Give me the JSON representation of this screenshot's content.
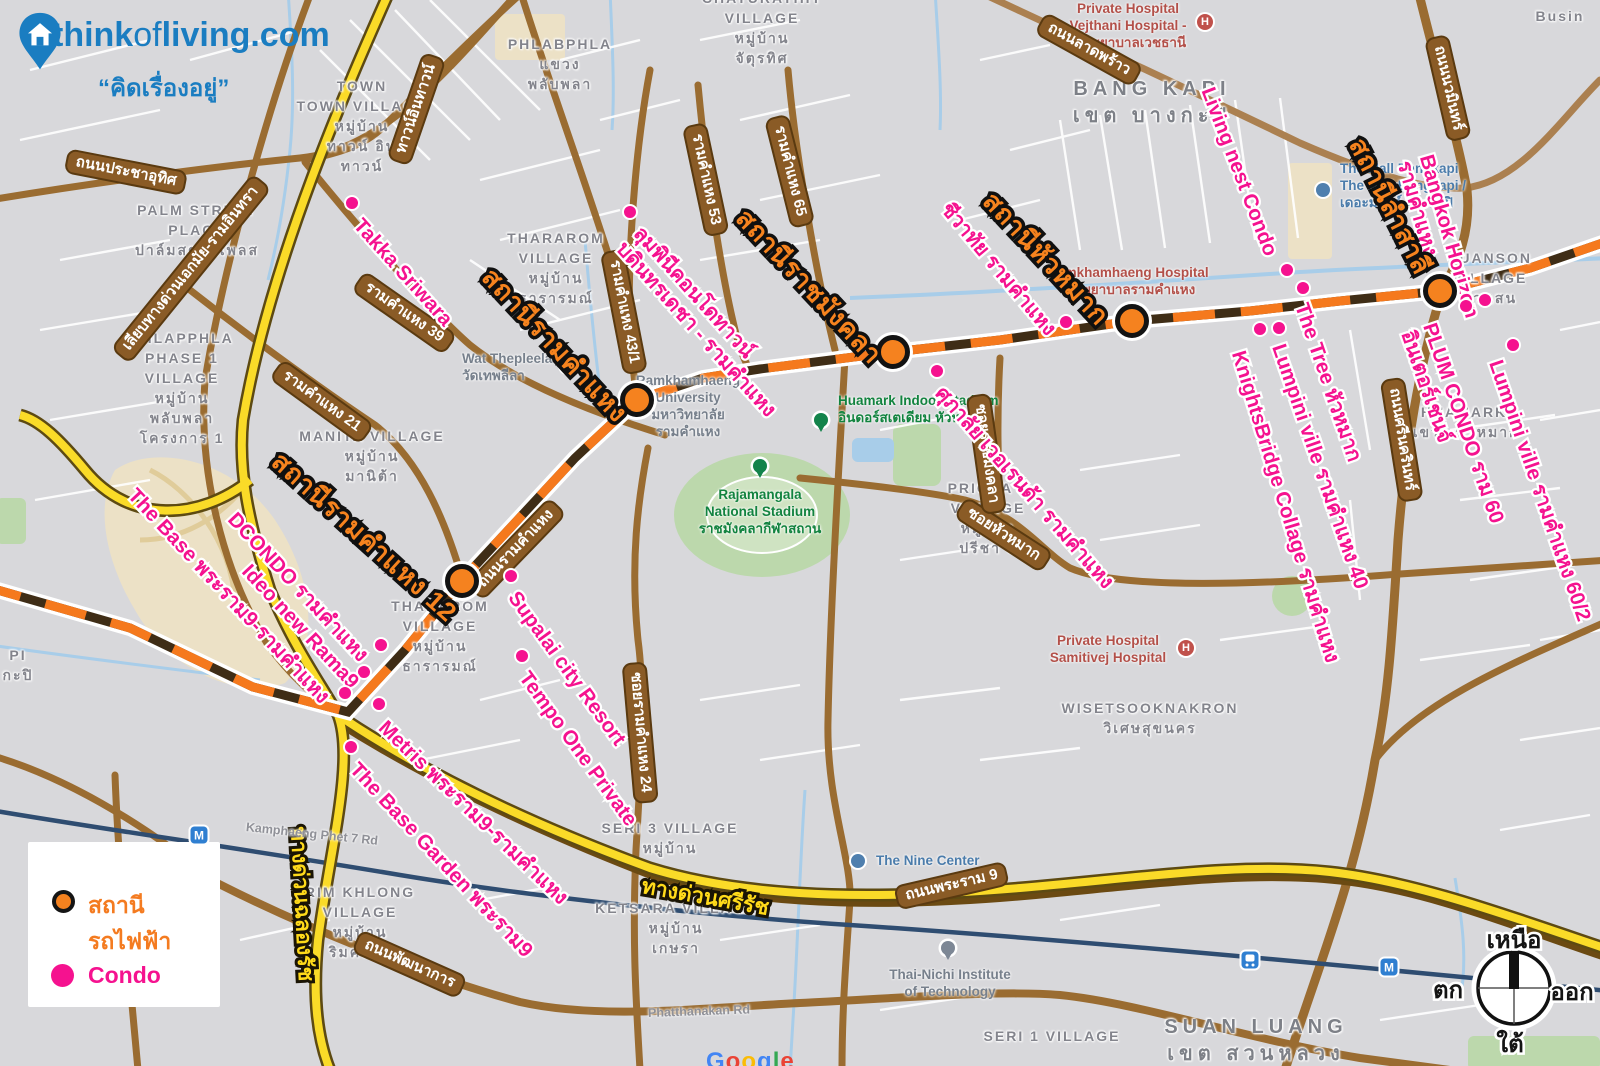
{
  "logo": {
    "site_think": "think",
    "site_of": "of",
    "site_living": "living.com",
    "tagline": "“คิดเรื่องอยู่”"
  },
  "legend": {
    "items": [
      {
        "label": "สถานีรถไฟฟ้า",
        "type": "station"
      },
      {
        "label": "Condo",
        "type": "condo"
      }
    ]
  },
  "compass": {
    "north": "เหนือ",
    "south": "ใต้",
    "west": "ตก",
    "east": "ออก"
  },
  "colors": {
    "transit_orange": "#f5791d",
    "condo_pink": "#f5128f",
    "station_label_orange": "#f6831e",
    "road_brown": "#9a6c31",
    "expressway_yellow": "#fadb28",
    "logo_blue": "#1a7dc1"
  },
  "icon_glyphs": {
    "hospital": "H",
    "metro": "M"
  },
  "watermark": {
    "text": "Google",
    "letter_colors": [
      "#4285F4",
      "#EA4335",
      "#FBBC05",
      "#4285F4",
      "#34A853",
      "#EA4335"
    ]
  },
  "stations": [
    {
      "name": "สถานีรามคำแหง 12",
      "marker": {
        "x": 462,
        "y": 581
      },
      "label": {
        "x": 286,
        "y": 446,
        "rot": 42
      }
    },
    {
      "name": "สถานีรามคำแหง",
      "marker": {
        "x": 637,
        "y": 400
      },
      "label": {
        "x": 498,
        "y": 262,
        "rot": 47
      }
    },
    {
      "name": "สถานีราชมังคลา",
      "marker": {
        "x": 893,
        "y": 352
      },
      "label": {
        "x": 752,
        "y": 203,
        "rot": 47
      }
    },
    {
      "name": "สถานีหัวหมาก",
      "marker": {
        "x": 1132,
        "y": 321
      },
      "label": {
        "x": 999,
        "y": 186,
        "rot": 47
      }
    },
    {
      "name": "สถานีลำสาลี",
      "marker": {
        "x": 1440,
        "y": 291
      },
      "label": {
        "x": 1370,
        "y": 133,
        "rot": 63
      }
    }
  ],
  "condos": [
    {
      "lines": [
        "Takka Sriwara"
      ],
      "dot": {
        "x": 352,
        "y": 203
      },
      "label": {
        "x": 366,
        "y": 214,
        "rot": 48
      }
    },
    {
      "lines": [
        "ลุมพินีคอนโดทาวน์",
        "บดินทรเดชา - รามคำแหง"
      ],
      "dot": {
        "x": 630,
        "y": 212
      },
      "label": {
        "x": 646,
        "y": 222,
        "rot": 48
      }
    },
    {
      "lines": [
        "ชีวาทัย รามคำแหง"
      ],
      "dot": {
        "x": 1066,
        "y": 322
      },
      "label": {
        "x": 954,
        "y": 198,
        "rot": 50
      }
    },
    {
      "lines": [
        "ศุภาลัย เวอเรนด้า รามคำแหง"
      ],
      "dot": {
        "x": 937,
        "y": 371
      },
      "label": {
        "x": 948,
        "y": 382,
        "rot": 49
      }
    },
    {
      "lines": [
        "DCONDO รามคำแหง"
      ],
      "dot": {
        "x": 381,
        "y": 645
      },
      "label": {
        "x": 240,
        "y": 508,
        "rot": 47
      }
    },
    {
      "lines": [
        "Ideo new Rama9"
      ],
      "dot": {
        "x": 364,
        "y": 672
      },
      "label": {
        "x": 254,
        "y": 560,
        "rot": 47
      }
    },
    {
      "lines": [
        "The Base พระราม9-รามคำแหง"
      ],
      "dot": {
        "x": 345,
        "y": 693
      },
      "label": {
        "x": 140,
        "y": 484,
        "rot": 47
      }
    },
    {
      "lines": [
        "Metris พระราม9-รามคำแหง"
      ],
      "dot": {
        "x": 379,
        "y": 704
      },
      "label": {
        "x": 390,
        "y": 716,
        "rot": 44
      }
    },
    {
      "lines": [
        "The Base Garden พระราม9"
      ],
      "dot": {
        "x": 351,
        "y": 747
      },
      "label": {
        "x": 362,
        "y": 758,
        "rot": 47
      }
    },
    {
      "lines": [
        "Supalai city Resort"
      ],
      "dot": {
        "x": 511,
        "y": 576
      },
      "label": {
        "x": 522,
        "y": 587,
        "rot": 54
      }
    },
    {
      "lines": [
        "Tempo One Private"
      ],
      "dot": {
        "x": 522,
        "y": 656
      },
      "label": {
        "x": 533,
        "y": 667,
        "rot": 54
      }
    },
    {
      "lines": [
        "Living nest Condo"
      ],
      "dot": {
        "x": 1287,
        "y": 270
      },
      "label": {
        "x": 1218,
        "y": 84,
        "rot": 69
      }
    },
    {
      "lines": [
        "The Tree หัวหมาก"
      ],
      "dot": {
        "x": 1303,
        "y": 288
      },
      "label": {
        "x": 1312,
        "y": 300,
        "rot": 71
      }
    },
    {
      "lines": [
        "Lumpini ville รามคำแหง 40"
      ],
      "dot": {
        "x": 1279,
        "y": 328
      },
      "label": {
        "x": 1289,
        "y": 341,
        "rot": 71
      }
    },
    {
      "lines": [
        "KnightsBridge Collage รามคำแหง"
      ],
      "dot": {
        "x": 1260,
        "y": 329
      },
      "label": {
        "x": 1249,
        "y": 348,
        "rot": 73
      }
    },
    {
      "lines": [
        "Bangkok Horizon",
        "รามคำแหง"
      ],
      "dot": {
        "x": 1485,
        "y": 300
      },
      "label": {
        "x": 1437,
        "y": 152,
        "rot": 74
      }
    },
    {
      "lines": [
        "PLUM CONDO ราม 60",
        "อินเตอร์เชนจ์"
      ],
      "dot": {
        "x": 1466,
        "y": 306
      },
      "label": {
        "x": 1440,
        "y": 320,
        "rot": 71
      }
    },
    {
      "lines": [
        "Lumpini ville รามคำแหง 60/2"
      ],
      "dot": {
        "x": 1513,
        "y": 345
      },
      "label": {
        "x": 1506,
        "y": 357,
        "rot": 71
      }
    }
  ],
  "road_labels": [
    {
      "text": "ถนนประชาอุทิศ",
      "x": 66,
      "y": 148,
      "rot": 11,
      "kind": "brown"
    },
    {
      "text": "เลียบทางด่วนเอกมัย-รามอินทรา",
      "x": 120,
      "y": 344,
      "rot": -51,
      "kind": "brown"
    },
    {
      "text": "ทาวน์อินทาวน์",
      "x": 398,
      "y": 150,
      "rot": -71,
      "kind": "brown"
    },
    {
      "text": "รามคำแหง 39",
      "x": 358,
      "y": 268,
      "rot": 35,
      "kind": "brown"
    },
    {
      "text": "รามคำแหง 21",
      "x": 276,
      "y": 356,
      "rot": 36,
      "kind": "brown"
    },
    {
      "text": "รามคำแหง 43/1",
      "x": 612,
      "y": 238,
      "rot": 79,
      "kind": "brown"
    },
    {
      "text": "รามคำแหง 53",
      "x": 694,
      "y": 112,
      "rot": 78,
      "kind": "brown"
    },
    {
      "text": "รามคำแหง 65",
      "x": 776,
      "y": 104,
      "rot": 76,
      "kind": "brown"
    },
    {
      "text": "ถนนลาดพร้าว",
      "x": 1040,
      "y": 10,
      "rot": 29,
      "kind": "brown"
    },
    {
      "text": "ถนนนวมินทร์",
      "x": 1436,
      "y": 24,
      "rot": 77,
      "kind": "brown"
    },
    {
      "text": "ถนนศรีนครินทร์",
      "x": 1392,
      "y": 366,
      "rot": 81,
      "kind": "brown"
    },
    {
      "text": "ถนนรามคำแหง",
      "x": 474,
      "y": 580,
      "rot": -46,
      "kind": "brown"
    },
    {
      "text": "ซอยรามคำแหง 24",
      "x": 634,
      "y": 650,
      "rot": 85,
      "kind": "brown"
    },
    {
      "text": "ซอยหัวหมาก",
      "x": 960,
      "y": 494,
      "rot": 33,
      "kind": "brown"
    },
    {
      "text": "ซอยราชมังคลา",
      "x": 978,
      "y": 382,
      "rot": 82,
      "kind": "brown"
    },
    {
      "text": "ถนนพระราม 9",
      "x": 896,
      "y": 886,
      "rot": -13,
      "kind": "brown"
    },
    {
      "text": "ถนนพัฒนาการ",
      "x": 356,
      "y": 928,
      "rot": 24,
      "kind": "brown"
    },
    {
      "text": "ทางด่วนศรีรัช",
      "x": 644,
      "y": 874,
      "rot": 10,
      "kind": "yellow"
    },
    {
      "text": "ทางด่วนฉลองรัช",
      "x": 310,
      "y": 826,
      "rot": 87,
      "kind": "yellow"
    },
    {
      "text": "Kamphaeng Phet 7 Rd",
      "x": 246,
      "y": 820,
      "rot": 6,
      "kind": "greyroad"
    },
    {
      "text": "Phatthanakan Rd",
      "x": 648,
      "y": 1006,
      "rot": -2,
      "kind": "greyroad"
    }
  ],
  "area_labels": [
    {
      "lines": [
        "PALM STREET",
        "PLACE",
        "ปาล์มสตรีทเพลส"
      ],
      "x": 197,
      "y": 200
    },
    {
      "lines": [
        "TOWN",
        "TOWN VILLAGE",
        "หมู่บ้าน",
        "ทาวน์ อิน",
        "ทาวน์"
      ],
      "x": 362,
      "y": 76
    },
    {
      "lines": [
        "PHLABPHLA",
        "แขวง",
        "พลับพลา"
      ],
      "x": 560,
      "y": 34
    },
    {
      "lines": [
        "PHLAPPHLA",
        "PHASE 1",
        "VILLAGE",
        "หมู่บ้าน",
        "พลับพลา",
        "โครงการ 1"
      ],
      "x": 182,
      "y": 328
    },
    {
      "lines": [
        "THARAROM",
        "VILLAGE",
        "หมู่บ้าน",
        "ธารารมณ์"
      ],
      "x": 556,
      "y": 228
    },
    {
      "lines": [
        "THARAROM",
        "VILLAGE",
        "หมู่บ้าน",
        "ธารารมณ์"
      ],
      "x": 440,
      "y": 596
    },
    {
      "lines": [
        "MANITA VILLAGE",
        "หมู่บ้าน",
        "มานิต้า"
      ],
      "x": 372,
      "y": 426
    },
    {
      "lines": [
        "PRICHA 8",
        "VILLAGE",
        "หมู่บ้าน",
        "ปรีชา 8"
      ],
      "x": 988,
      "y": 478
    },
    {
      "lines": [
        "SERI 3 VILLAGE",
        "หมู่บ้าน"
      ],
      "x": 670,
      "y": 818
    },
    {
      "lines": [
        "KETSARA VILLAGE",
        "หมู่บ้าน",
        "เกษรา"
      ],
      "x": 676,
      "y": 898
    },
    {
      "lines": [
        "SERI 1 VILLAGE"
      ],
      "x": 1052,
      "y": 1026
    },
    {
      "lines": [
        "RIM KHLONG",
        "VILLAGE",
        "หมู่บ้าน",
        "ริมคลอง"
      ],
      "x": 360,
      "y": 882
    },
    {
      "lines": [
        "WISETSOOKNAKRON",
        "วิเศษสุขนคร"
      ],
      "x": 1150,
      "y": 698
    },
    {
      "lines": [
        "BANG KAPI",
        "เขต บางกะปิ"
      ],
      "x": 1152,
      "y": 76,
      "cls": "district"
    },
    {
      "lines": [
        "SUAN LUANG",
        "เขต สวนหลวง"
      ],
      "x": 1256,
      "y": 1014,
      "cls": "district"
    },
    {
      "lines": [
        "HUAMARK",
        "แขวง หัวหมาก"
      ],
      "x": 1464,
      "y": 402
    },
    {
      "lines": [
        "SUANSON",
        "VILLAGE",
        "สวนสน"
      ],
      "x": 1490,
      "y": 248
    },
    {
      "lines": [
        "PI",
        "กะปิ"
      ],
      "x": 18,
      "y": 645
    },
    {
      "lines": [
        "CHATURATHIT",
        "VILLAGE",
        "หมู่บ้าน",
        "จัตุรทิศ"
      ],
      "x": 762,
      "y": -12
    },
    {
      "lines": [
        "Busin"
      ],
      "x": 1560,
      "y": 6
    }
  ],
  "pois": [
    {
      "lines": [
        "Wat Thepleela",
        "วัดเทพลีลา"
      ],
      "x": 462,
      "y": 350,
      "cls": "grey",
      "icon": {
        "type": "cir",
        "color": "#8a9bb0",
        "x": 567,
        "y": 366
      }
    },
    {
      "lines": [
        "Ramkhamhaeng",
        "University",
        "มหาวิทยาลัย",
        "รามคำแหง"
      ],
      "x": 688,
      "y": 372,
      "cls": "grey c"
    },
    {
      "lines": [
        "Rajamangala",
        "National Stadium",
        "ราชมังคลากีฬาสถาน"
      ],
      "x": 760,
      "y": 486,
      "cls": "green c",
      "icon": {
        "type": "pin",
        "color": "#13834b",
        "x": 760,
        "y": 466
      }
    },
    {
      "lines": [
        "Huamark Indoor Stadium",
        "อินดอร์สเตเดียม หัวหมาก"
      ],
      "x": 838,
      "y": 392,
      "cls": "green",
      "icon": {
        "type": "pin",
        "color": "#13834b",
        "x": 821,
        "y": 420
      }
    },
    {
      "lines": [
        "The Nine Center"
      ],
      "x": 876,
      "y": 852,
      "cls": "blue",
      "icon": {
        "type": "cir",
        "color": "#4f7fae",
        "x": 858,
        "y": 861
      }
    },
    {
      "lines": [
        "Thai-Nichi Institute",
        "of Technology"
      ],
      "x": 950,
      "y": 966,
      "cls": "grey c",
      "icon": {
        "type": "pin",
        "color": "#7d8795",
        "x": 948,
        "y": 948
      }
    },
    {
      "lines": [
        "The Mall Bangkapi",
        "The Mall Bangkapi /",
        "เดอะมอลล์ บางกะปิ"
      ],
      "x": 1340,
      "y": 160,
      "cls": "blue",
      "icon": {
        "type": "cir",
        "color": "#4f7fae",
        "x": 1323,
        "y": 190
      }
    },
    {
      "lines": [
        "Ramkhamhaeng Hospital",
        "โรงพยาบาลรามคำแหง"
      ],
      "x": 1128,
      "y": 264,
      "cls": "red c"
    },
    {
      "lines": [
        "Private Hospital",
        "Vejthani Hospital -",
        "โรงพยาบาลเวชธานี"
      ],
      "x": 1128,
      "y": 0,
      "cls": "red c",
      "icon": {
        "type": "hsq",
        "color": "#c0514b",
        "x": 1205,
        "y": 22
      }
    },
    {
      "lines": [
        "Private Hospital",
        "Samitivej Hospital"
      ],
      "x": 1108,
      "y": 632,
      "cls": "red c",
      "icon": {
        "type": "hsq",
        "color": "#c0514b",
        "x": 1186,
        "y": 648
      }
    }
  ],
  "transit_icons": [
    {
      "type": "msq",
      "x": 199,
      "y": 835
    },
    {
      "type": "msq",
      "x": 1389,
      "y": 967
    },
    {
      "type": "trn",
      "x": 1250,
      "y": 960
    }
  ]
}
